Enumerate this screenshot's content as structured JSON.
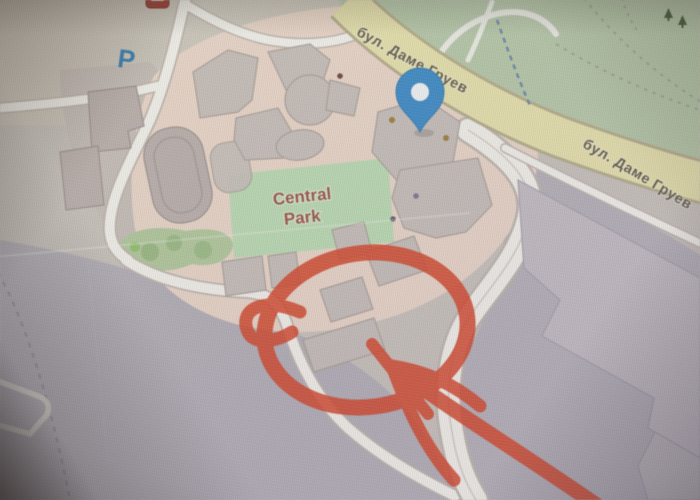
{
  "map": {
    "street_labels": {
      "top": "бул. Даме Груев",
      "right": "бул. Даме Груев"
    },
    "park_label": {
      "line1": "Central",
      "line2": "Park"
    },
    "parking_label": "P",
    "icons": {
      "location_pin": "location-pin-icon",
      "parking": "parking-icon",
      "poi_marker": "poi-marker-icon",
      "trees": "trees-icon"
    },
    "colors": {
      "annotation_red": "#dd3c1c",
      "pin_blue": "#2f87cb",
      "pin_border": "#2a77b4",
      "parking_blue": "#2879b5",
      "street_fill": "#e8e2a6",
      "street_casing": "#b3ab85",
      "green_area": "#b3c8a4",
      "park_green": "#b7dcae",
      "urban_pink": "#ebd5c6",
      "building_gray": "#c6bdb7",
      "lavender": "#b3aeb7",
      "road_white": "#f5f2ec",
      "street_label_color": "#5a5440",
      "park_label_color": "#9c4b38"
    },
    "annotation": {
      "description": "hand-drawn red circle with arrow"
    }
  }
}
